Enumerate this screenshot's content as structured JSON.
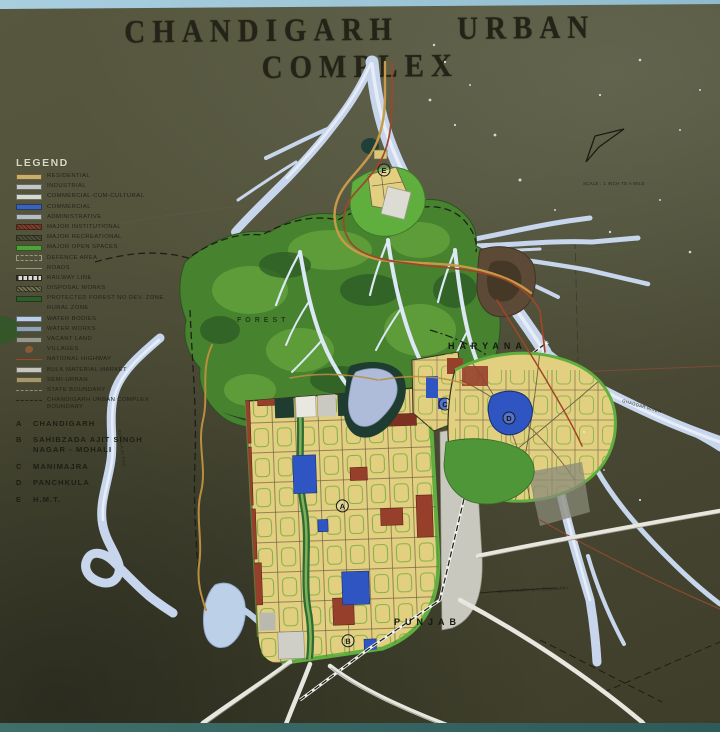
{
  "title": "CHANDIGARH URBAN COMPLEX",
  "legend": {
    "heading": "LEGEND",
    "items": [
      {
        "label": "RESIDENTIAL",
        "kind": "fill",
        "color": "#c9ae6b"
      },
      {
        "label": "INDUSTRIAL",
        "kind": "fill",
        "color": "#c2c6c7"
      },
      {
        "label": "COMMERCIAL-CUM-CULTURAL",
        "kind": "fill",
        "color": "#d8dad2"
      },
      {
        "label": "COMMERCIAL",
        "kind": "fill",
        "color": "#3b62bf"
      },
      {
        "label": "ADMINISTRATIVE",
        "kind": "fill",
        "color": "#b6bcbf"
      },
      {
        "label": "MAJOR INSTITUTIONAL",
        "kind": "hatch",
        "color": "#8c392c"
      },
      {
        "label": "MAJOR RECREATIONAL",
        "kind": "hatch",
        "color": "#4a4f3a"
      },
      {
        "label": "MAJOR OPEN SPACES",
        "kind": "fill",
        "color": "#4da23a"
      },
      {
        "label": "DEFENCE AREA",
        "kind": "outline",
        "color": "#9a9a82"
      },
      {
        "label": "ROADS",
        "kind": "line",
        "color": "#98987e"
      },
      {
        "label": "RAILWAY LINE",
        "kind": "rail",
        "color": "#d9d9d4"
      },
      {
        "label": "DISPOSAL WORKS",
        "kind": "hatch",
        "color": "#6f6f52"
      },
      {
        "label": "PROTECTED FOREST NO DEV. ZONE",
        "kind": "fill",
        "color": "#2f5e2d"
      },
      {
        "label": "RURAL ZONE",
        "kind": "none",
        "color": "transparent"
      },
      {
        "label": "WATER BODIES",
        "kind": "fill",
        "color": "#b9cfe7"
      },
      {
        "label": "WATER WORKS",
        "kind": "fill",
        "color": "#8fa3b2"
      },
      {
        "label": "VACANT LAND",
        "kind": "fill",
        "color": "#97978b"
      },
      {
        "label": "VILLAGES",
        "kind": "dot",
        "color": "#8a5a36"
      },
      {
        "label": "NATIONAL HIGHWAY",
        "kind": "line",
        "color": "#a04628"
      },
      {
        "label": "BULK MATERIAL MARKET",
        "kind": "fill",
        "color": "#c6c6bf"
      },
      {
        "label": "SEMI-URBAN",
        "kind": "fill",
        "color": "#a3976b"
      },
      {
        "label": "STATE BOUNDARY",
        "kind": "dash",
        "color": "#8f8f74"
      },
      {
        "label": "CHANDIGARH URBAN COMPLEX BOUNDARY",
        "kind": "dashdot",
        "color": "#26261c"
      }
    ],
    "key": [
      {
        "letter": "A",
        "name": "CHANDIGARH",
        "name2": ""
      },
      {
        "letter": "B",
        "name": "SAHIBZADA AJIT SINGH",
        "name2": "NAGAR - MOHALI"
      },
      {
        "letter": "C",
        "name": "MANIMAJRA",
        "name2": ""
      },
      {
        "letter": "D",
        "name": "PANCHKULA",
        "name2": ""
      },
      {
        "letter": "E",
        "name": "H.M.T.",
        "name2": ""
      }
    ]
  },
  "map": {
    "labels": {
      "state_right": "HARYANA",
      "state_bottom": "PUNJAB",
      "forest": "FOREST",
      "river_right": "GHAGGAR RIVER",
      "river_left": "PATIALA KI RAO",
      "boundary_note": "CHANDIGARH U.T. BOUNDARY"
    },
    "scale_text": "SCALE : 1 INCH TO A MILE"
  },
  "colors": {
    "board_olive": "#4e4e38",
    "water_blue": "#c3d3e8",
    "forest_green": "#47822f",
    "residential_yellow": "#e3cf80",
    "commercial_blue": "#2f55c2",
    "institutional_red": "#96402c",
    "open_space_green": "#54a33c",
    "wall_blue": "#a9cfdf"
  }
}
